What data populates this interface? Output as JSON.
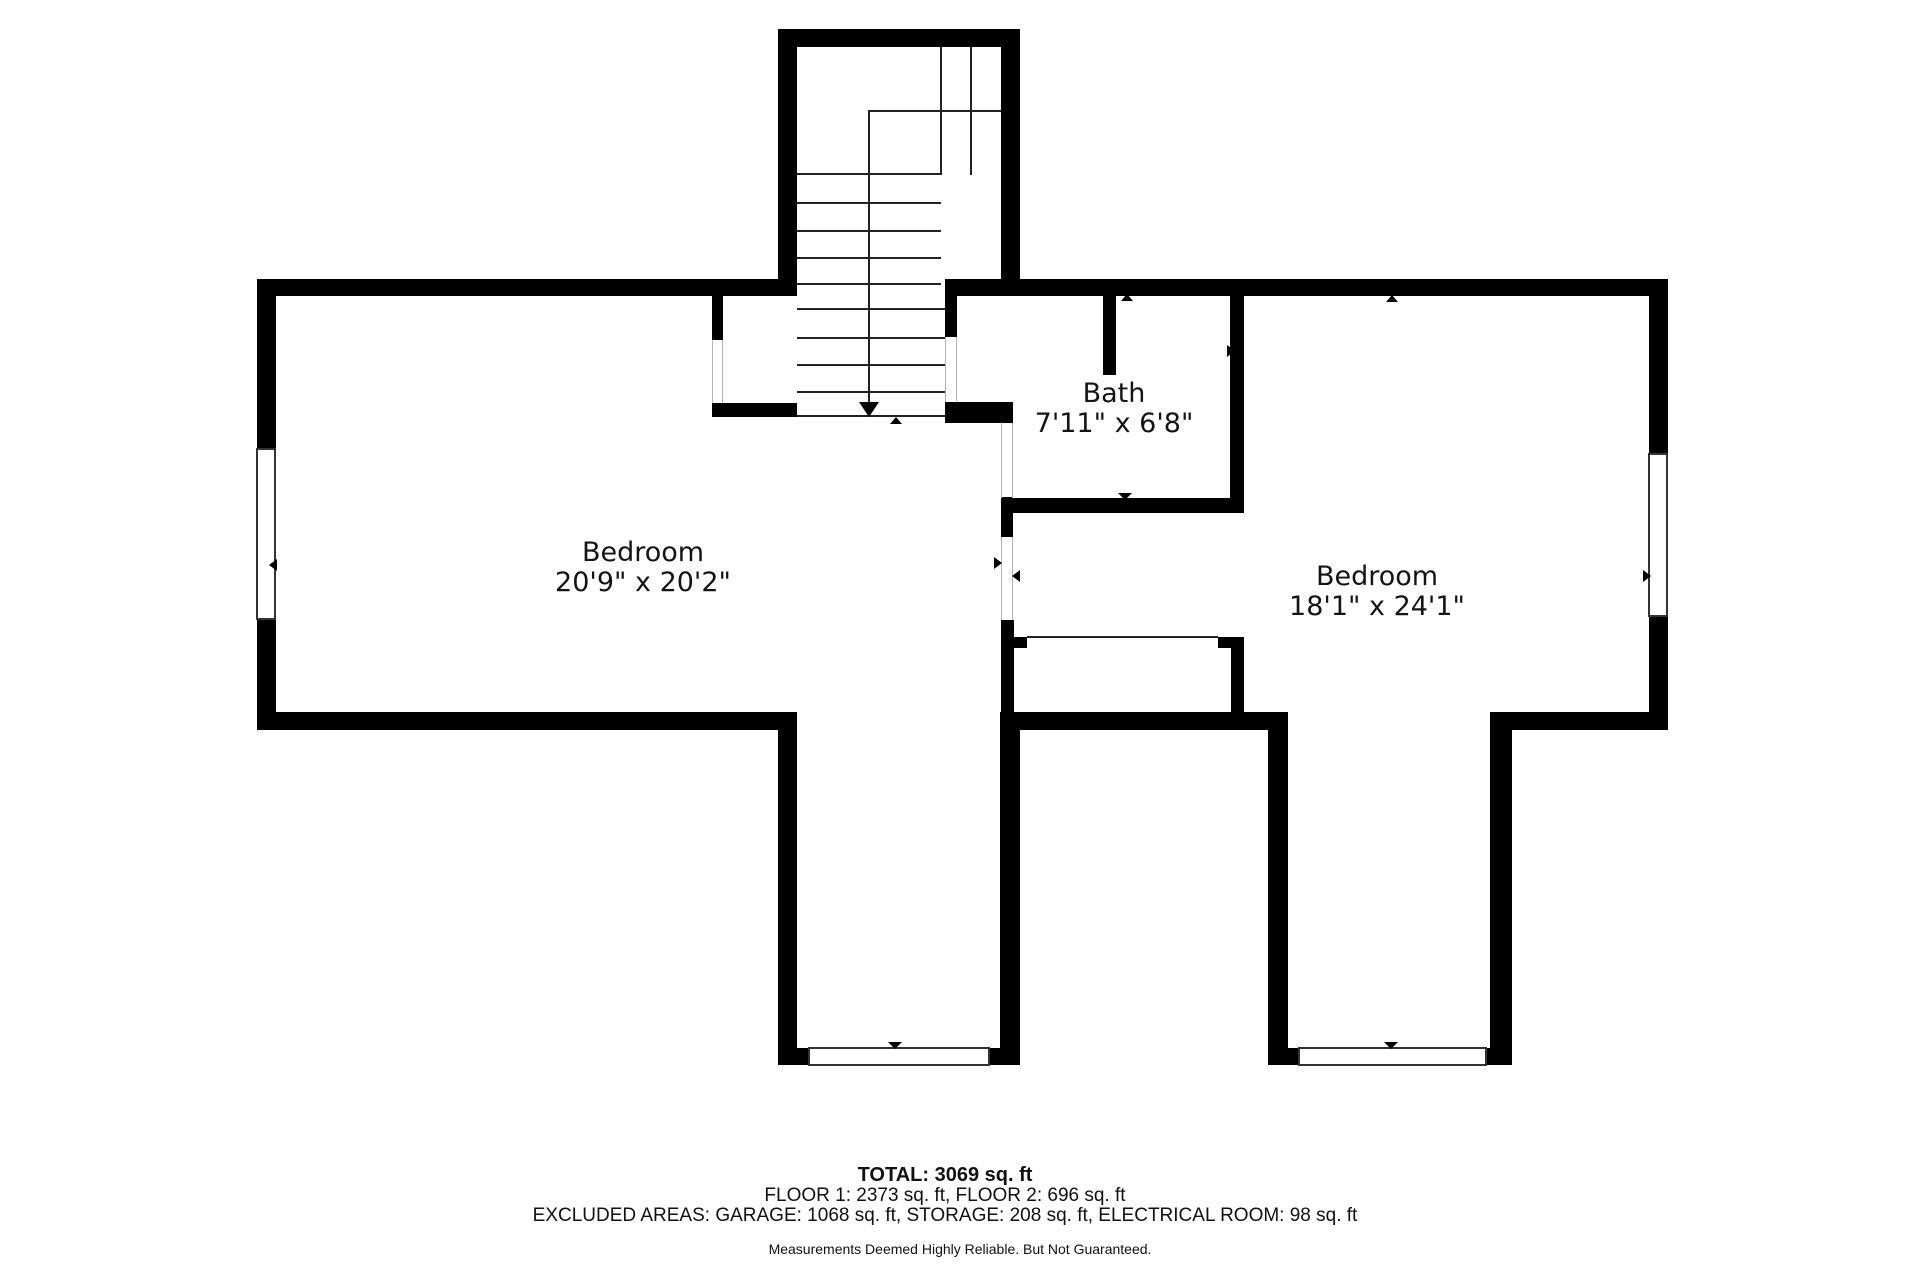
{
  "colors": {
    "wall": "#000000",
    "line": "#222222",
    "jamb": "#b5b5b5",
    "text": "#141414"
  },
  "rooms": [
    {
      "name": "Bedroom",
      "dims": "20'9\" x 20'2\"",
      "cx": 643,
      "cy": 568
    },
    {
      "name": "Bath",
      "dims": "7'11\" x 6'8\"",
      "cx": 1114,
      "cy": 409
    },
    {
      "name": "Bedroom",
      "dims": "18'1\" x 24'1\"",
      "cx": 1377,
      "cy": 592
    }
  ],
  "stats": {
    "total": "TOTAL: 3069 sq. ft",
    "floors": "FLOOR 1: 2373 sq. ft, FLOOR 2: 696 sq. ft",
    "excluded": "EXCLUDED AREAS: GARAGE: 1068 sq. ft, STORAGE: 208 sq. ft, ELECTRICAL ROOM: 98 sq. ft",
    "disclaimer": "Measurements Deemed Highly Reliable. But Not Guaranteed."
  },
  "walls": [
    [
      778,
      29,
      242,
      18
    ],
    [
      778,
      29,
      19,
      267
    ],
    [
      1001,
      29,
      19,
      267
    ],
    [
      257,
      279,
      521,
      17
    ],
    [
      945,
      279,
      723,
      17
    ],
    [
      257,
      279,
      19,
      169
    ],
    [
      257,
      620,
      19,
      110
    ],
    [
      1649,
      279,
      19,
      174
    ],
    [
      1649,
      617,
      19,
      113
    ],
    [
      257,
      712,
      540,
      18
    ],
    [
      1490,
      712,
      178,
      18
    ],
    [
      1000,
      712,
      288,
      18
    ],
    [
      778,
      712,
      19,
      353
    ],
    [
      1000,
      712,
      20,
      353
    ],
    [
      778,
      1048,
      31,
      17
    ],
    [
      989,
      1048,
      31,
      17
    ],
    [
      1268,
      712,
      20,
      353
    ],
    [
      1490,
      712,
      22,
      353
    ],
    [
      1268,
      1048,
      31,
      17
    ],
    [
      1486,
      1048,
      26,
      17
    ],
    [
      712,
      296,
      11,
      44
    ],
    [
      712,
      403,
      85,
      14
    ],
    [
      945,
      296,
      12,
      41
    ],
    [
      945,
      402,
      68,
      21
    ],
    [
      1001,
      497,
      12,
      40
    ],
    [
      1001,
      620,
      13,
      92
    ],
    [
      1103,
      296,
      13,
      79
    ],
    [
      1230,
      296,
      14,
      217
    ],
    [
      1001,
      498,
      243,
      15
    ],
    [
      1231,
      637,
      13,
      93
    ],
    [
      1013,
      637,
      14,
      11
    ],
    [
      1218,
      637,
      26,
      11
    ]
  ],
  "lines": [
    [
      797,
      173,
      144,
      2
    ],
    [
      797,
      202,
      144,
      2
    ],
    [
      797,
      230,
      144,
      2
    ],
    [
      797,
      257,
      144,
      2
    ],
    [
      797,
      283,
      144,
      2
    ],
    [
      797,
      308,
      148,
      2
    ],
    [
      797,
      337,
      148,
      2
    ],
    [
      797,
      364,
      148,
      2
    ],
    [
      797,
      391,
      148,
      2
    ],
    [
      797,
      415,
      148,
      2
    ],
    [
      869,
      110,
      132,
      2
    ],
    [
      868,
      110,
      2,
      294
    ],
    [
      940,
      47,
      2,
      128
    ],
    [
      970,
      47,
      2,
      128
    ],
    [
      1027,
      636,
      191,
      2
    ],
    [
      257,
      455,
      18,
      2
    ],
    [
      257,
      526,
      18,
      2
    ],
    [
      257,
      540,
      18,
      2
    ],
    [
      257,
      612,
      18,
      2
    ],
    [
      265,
      457,
      2,
      69
    ],
    [
      265,
      542,
      2,
      70
    ],
    [
      1649,
      460,
      18,
      2
    ],
    [
      1649,
      529,
      18,
      2
    ],
    [
      1649,
      540,
      18,
      2
    ],
    [
      1649,
      610,
      18,
      2
    ],
    [
      1657,
      462,
      2,
      67
    ],
    [
      1657,
      542,
      2,
      68
    ],
    [
      816,
      1048,
      2,
      17
    ],
    [
      892,
      1048,
      2,
      17
    ],
    [
      905,
      1048,
      2,
      17
    ],
    [
      979,
      1048,
      2,
      17
    ],
    [
      818,
      1055,
      74,
      2
    ],
    [
      907,
      1055,
      72,
      2
    ],
    [
      1306,
      1048,
      2,
      17
    ],
    [
      1384,
      1048,
      2,
      17
    ],
    [
      1397,
      1048,
      2,
      17
    ],
    [
      1476,
      1048,
      2,
      17
    ],
    [
      1308,
      1055,
      76,
      2
    ],
    [
      1399,
      1055,
      77,
      2
    ]
  ],
  "jambs": [
    [
      712,
      340,
      1,
      63
    ],
    [
      722,
      340,
      1,
      63
    ],
    [
      945,
      337,
      1,
      65
    ],
    [
      956,
      337,
      1,
      65
    ],
    [
      1001,
      423,
      1,
      75
    ],
    [
      1012,
      423,
      1,
      75
    ],
    [
      1001,
      537,
      1,
      83
    ],
    [
      1012,
      537,
      1,
      83
    ]
  ],
  "windows": [
    [
      256,
      448,
      20,
      172
    ],
    [
      1648,
      453,
      20,
      164
    ],
    [
      808,
      1047,
      182,
      19
    ],
    [
      1298,
      1047,
      189,
      19
    ]
  ],
  "arrows": [
    [
      "down",
      859,
      402,
      20,
      15
    ],
    [
      "up",
      890,
      417,
      13,
      7
    ],
    [
      "up",
      1121,
      294,
      13,
      7
    ],
    [
      "right",
      1227,
      345,
      8,
      13
    ],
    [
      "down",
      1118,
      493,
      14,
      7
    ],
    [
      "right",
      994,
      557,
      8,
      13
    ],
    [
      "left",
      1012,
      570,
      8,
      13
    ],
    [
      "left",
      269,
      559,
      8,
      13
    ],
    [
      "right",
      1643,
      570,
      8,
      13
    ],
    [
      "up",
      1386,
      295,
      13,
      7
    ],
    [
      "down",
      888,
      1042,
      14,
      7
    ],
    [
      "down",
      1384,
      1042,
      14,
      7
    ]
  ]
}
